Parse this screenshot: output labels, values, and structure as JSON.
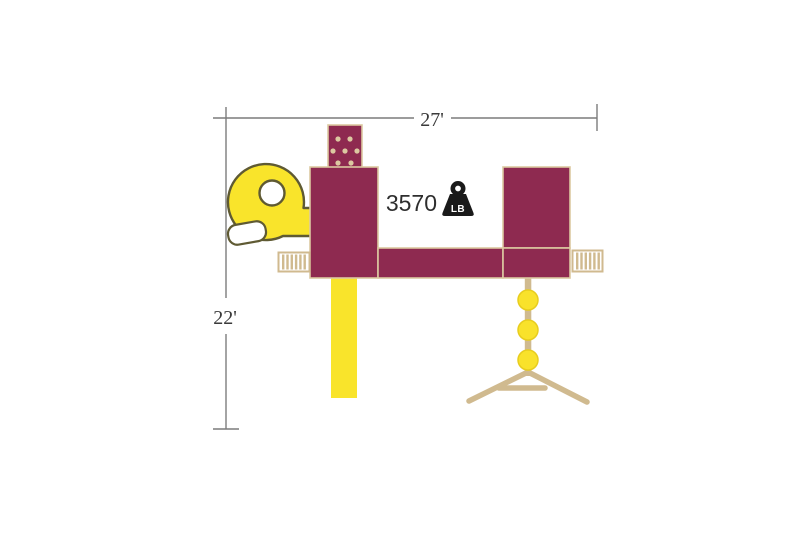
{
  "canvas": {
    "background": "#ffffff"
  },
  "colors": {
    "background": "#ffffff",
    "maroon": "#8e2a50",
    "outline_tan": "#dcc9a1",
    "structure_tan": "#d0ba8f",
    "slide_yellow": "#f9e42b",
    "spiral_outline": "#5f5a33",
    "chute_white": "#ffffff",
    "pod_yellow": "#f9e22b",
    "pod_stroke": "#e8cd1e",
    "dim_line": "#7c7c7c",
    "label_text": "#3a3a3a",
    "weight_text": "#2e2e2e",
    "weight_icon": "#1a1a1a",
    "weight_unit_text": "#ffffff"
  },
  "dimension_annotations": {
    "width": {
      "label": "27'"
    },
    "height": {
      "label": "22'"
    }
  },
  "weight_callout": {
    "value": "3570",
    "unit": "LB",
    "icon": "weight-icon"
  }
}
